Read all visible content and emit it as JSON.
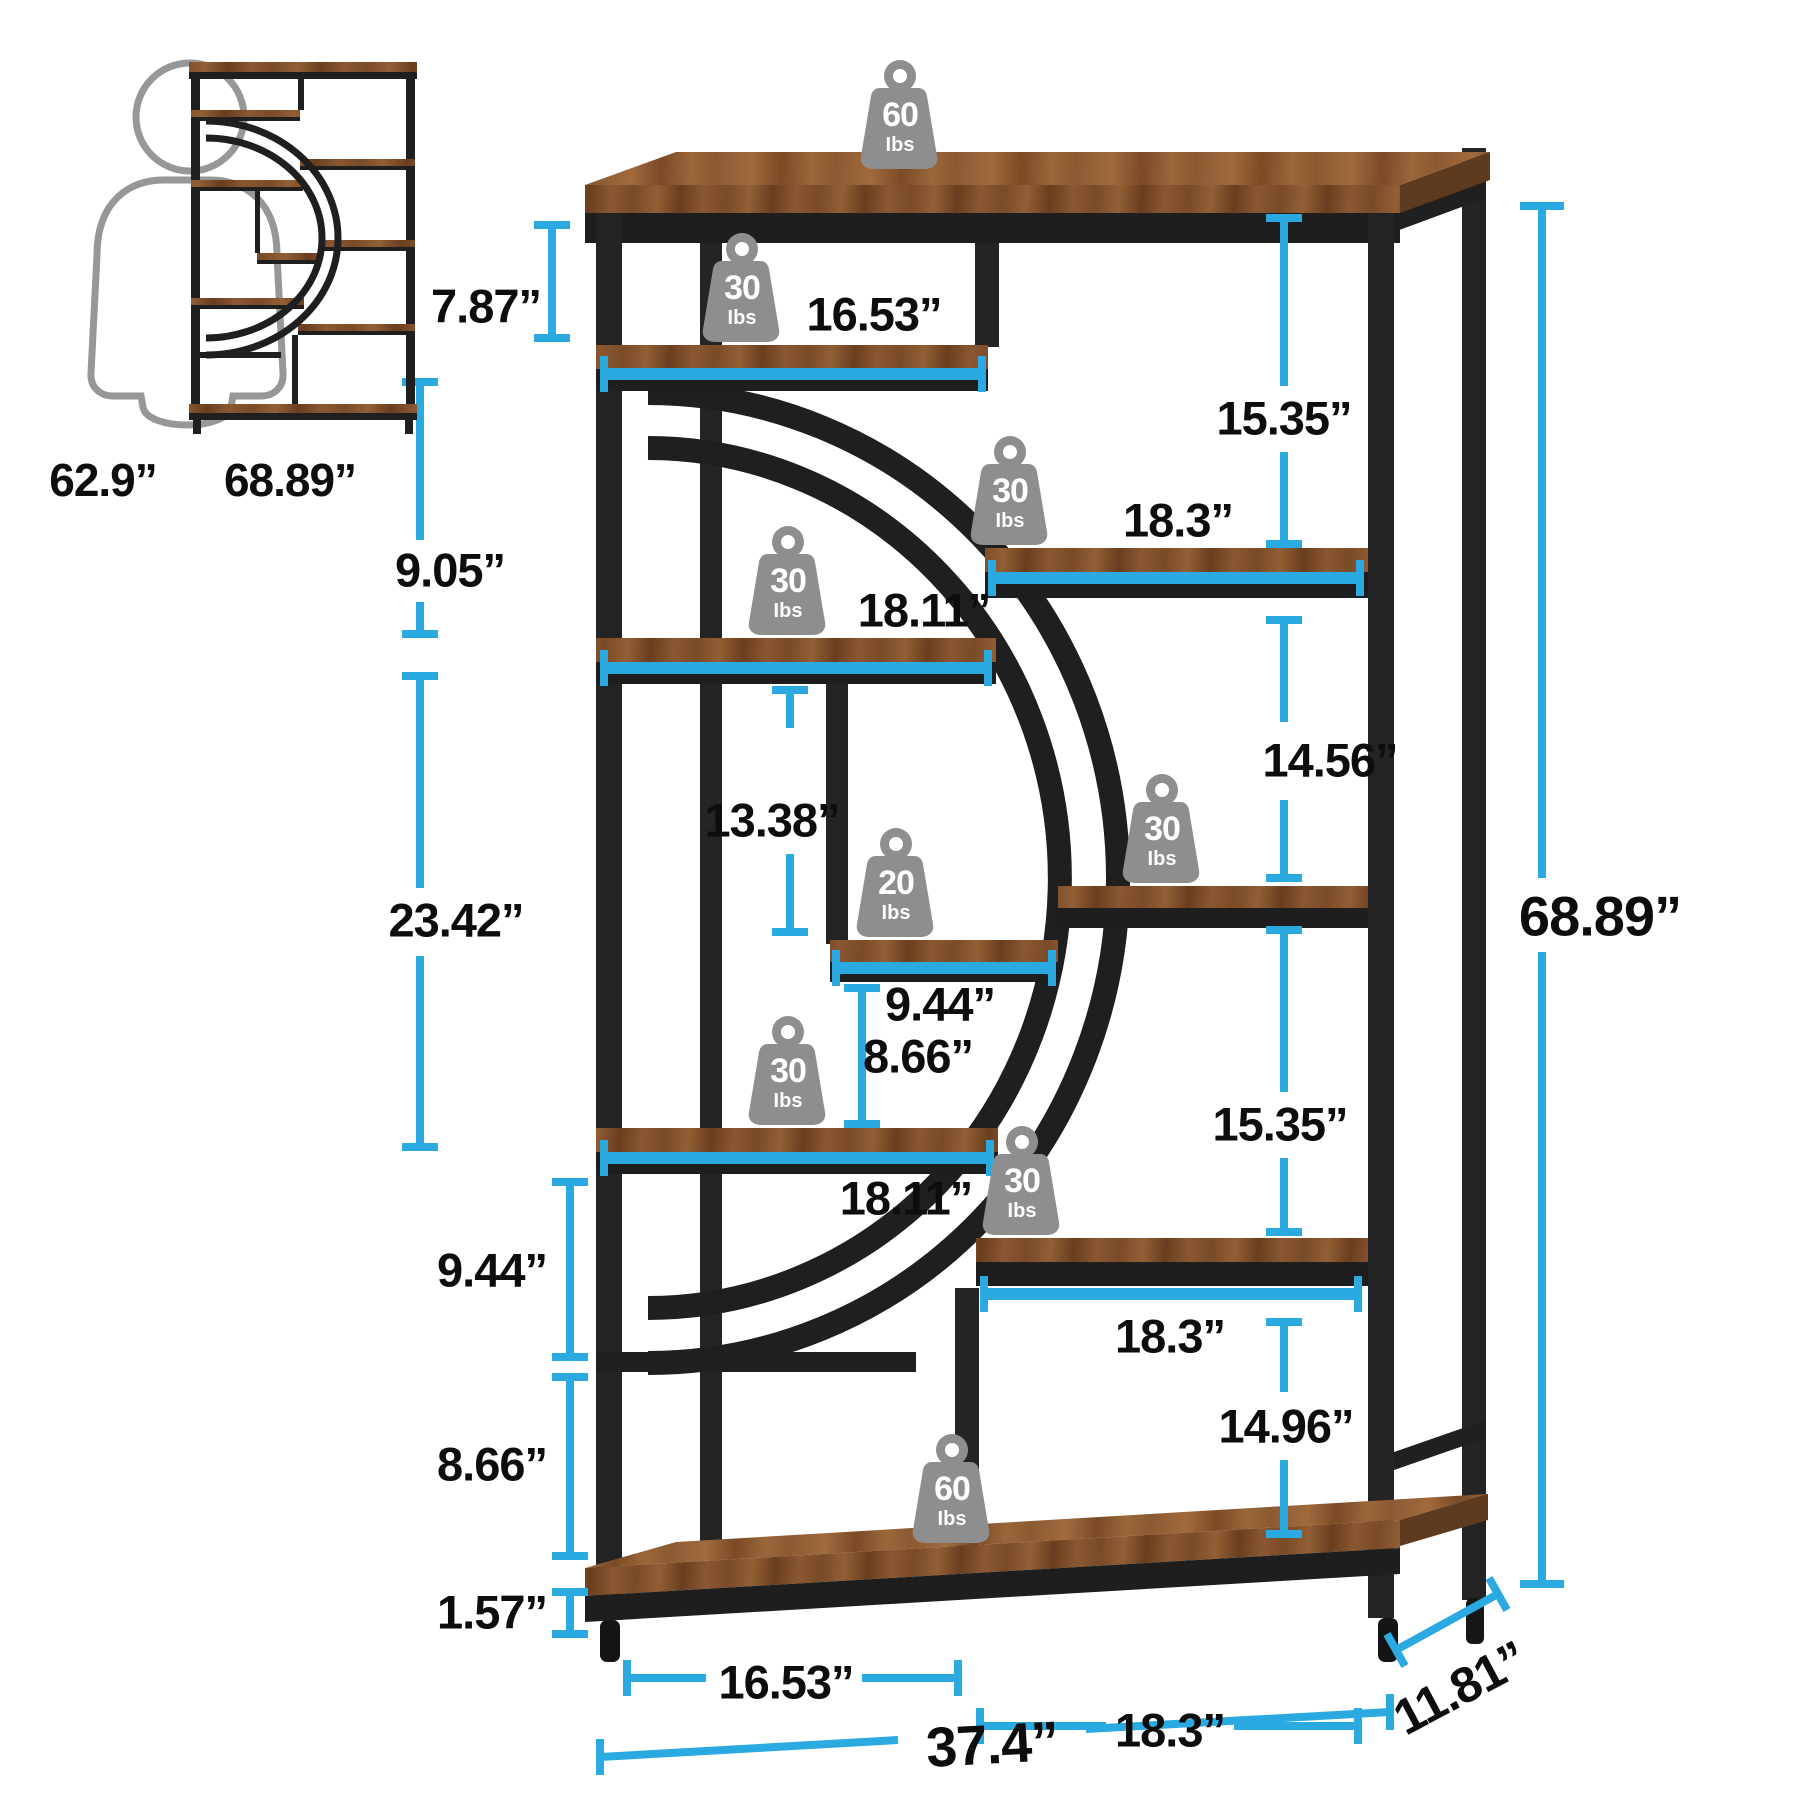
{
  "colors": {
    "accent": "#2BAAE2",
    "wood": "#7C4E2A",
    "metal": "#1F1F1F",
    "weight_gray": "#8E8E8E"
  },
  "scale_reference": {
    "person_height": "62.9”",
    "bookcase_height": "68.89”"
  },
  "weights": [
    {
      "value": "60",
      "unit": "Ibs",
      "location": "top-shelf"
    },
    {
      "value": "30",
      "unit": "Ibs",
      "location": "upper-left-shelf"
    },
    {
      "value": "30",
      "unit": "Ibs",
      "location": "upper-right-shelf"
    },
    {
      "value": "30",
      "unit": "Ibs",
      "location": "mid-left-shelf"
    },
    {
      "value": "20",
      "unit": "Ibs",
      "location": "center-small-shelf"
    },
    {
      "value": "30",
      "unit": "Ibs",
      "location": "mid-right-shelf"
    },
    {
      "value": "30",
      "unit": "Ibs",
      "location": "lower-left-shelf"
    },
    {
      "value": "30",
      "unit": "Ibs",
      "location": "lower-right-shelf"
    },
    {
      "value": "60",
      "unit": "Ibs",
      "location": "bottom-shelf"
    }
  ],
  "dims": {
    "left": [
      "7.87”",
      "9.05”",
      "23.42”",
      "9.44”",
      "8.66”",
      "1.57”"
    ],
    "middle": [
      "16.53”",
      "18.3”",
      "18.11”",
      "13.38”",
      "9.44”",
      "8.66”",
      "18.11”",
      "18.3”"
    ],
    "right": [
      "15.35”",
      "14.56”",
      "15.35”",
      "14.96”"
    ],
    "overall": {
      "height": "68.89”",
      "width": "37.4”",
      "depth": "11.81”",
      "bottom_left": "16.53”",
      "bottom_right": "18.3”"
    }
  }
}
